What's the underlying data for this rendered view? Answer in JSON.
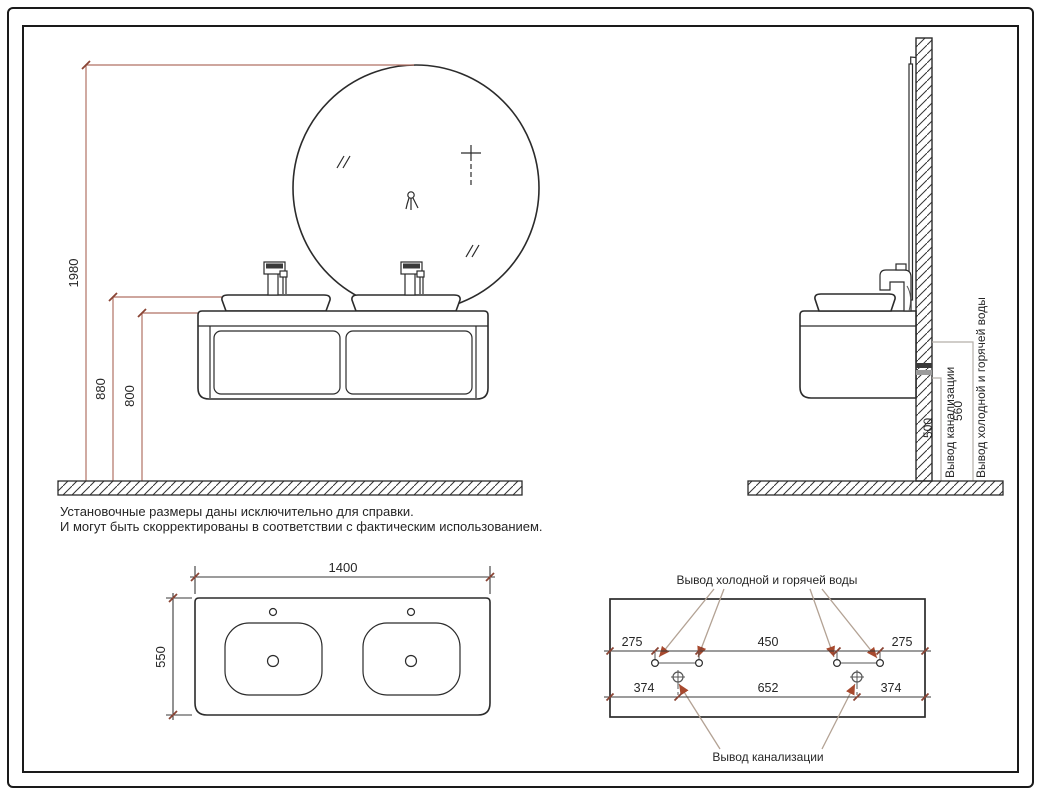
{
  "drawing": {
    "note": {
      "line1": "Установочные размеры даны исключительно для справки.",
      "line2": "И могут быть скорректированы в соответствии с фактическим использованием."
    },
    "front_view": {
      "height_total": "1980",
      "height_sink_top": "880",
      "height_cabinet_top": "800"
    },
    "side_view": {
      "sewer_height": "500",
      "sewer_label": "Вывод канализации",
      "water_height": "560",
      "water_label": "Вывод холодной и горячей воды"
    },
    "top_view": {
      "width": "1400",
      "depth": "550"
    },
    "wall_layout": {
      "water_label": "Вывод холодной и горячей воды",
      "sewer_label": "Вывод канализации",
      "water_dim_left": "275",
      "water_dim_center": "450",
      "water_dim_right": "275",
      "sewer_dim_left": "374",
      "sewer_dim_center": "652",
      "sewer_dim_right": "374"
    },
    "colors": {
      "line": "#2b2b2b",
      "dimension_red": "#b17265",
      "tick_red": "#8a4434",
      "leader_tan": "#b3a294",
      "arrow_red": "#a7492e",
      "dimension_gray": "#b5afa9"
    }
  }
}
